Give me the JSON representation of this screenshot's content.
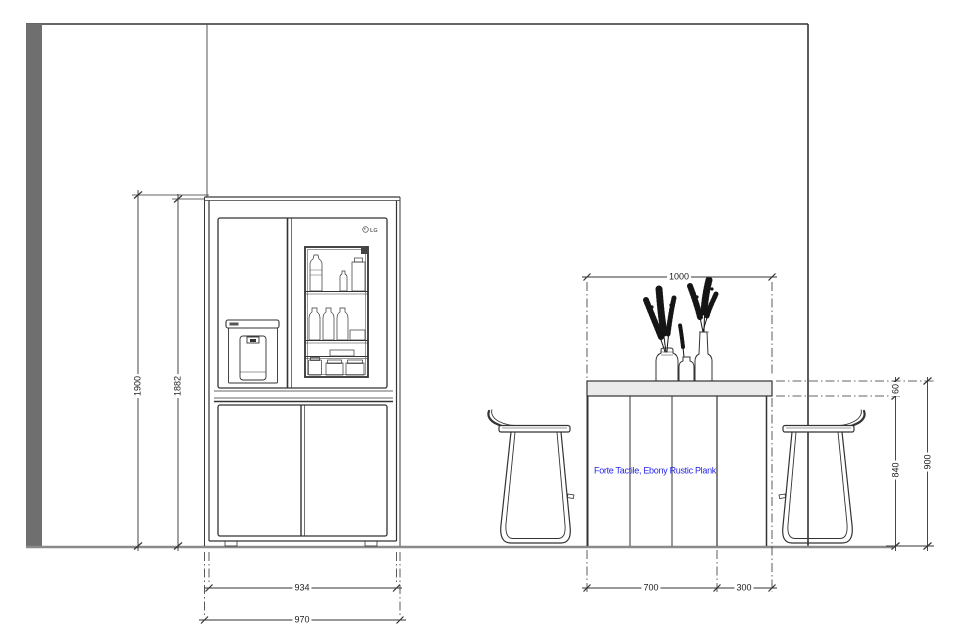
{
  "drawing": {
    "view": "kitchen elevation",
    "dimensions": {
      "niche_height": "1900",
      "fridge_height": "1882",
      "fridge_width": "934",
      "niche_width": "970",
      "table_top_width": "1000",
      "table_base_width": "700",
      "stool_clearance": "300",
      "top_thickness": "60",
      "counter_underside_height": "840",
      "counter_height": "900"
    },
    "notes": {
      "table_material": "Forte Tactile, Ebony Rustic Plank"
    },
    "fridge": {
      "brand": "LG"
    },
    "colors": {
      "line": "#333333",
      "wall_fill": "#6f6f6f",
      "floor_line": "#8a8a8a",
      "tabletop_fill": "#ebebeb",
      "note_text": "#2424ee"
    }
  }
}
